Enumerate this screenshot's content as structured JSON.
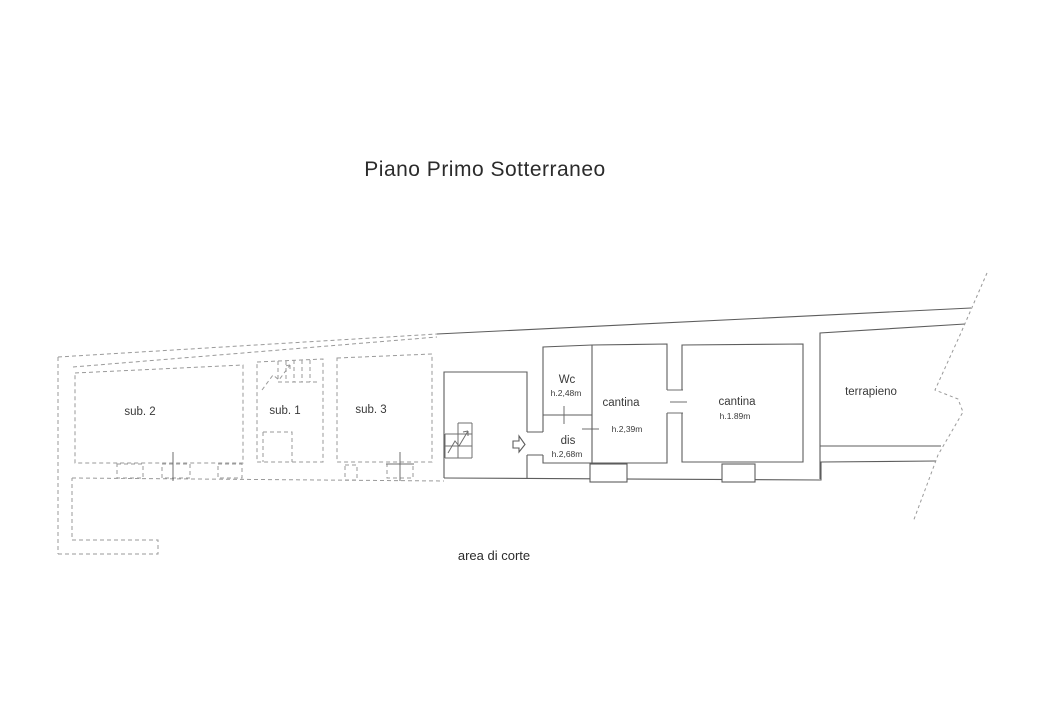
{
  "page": {
    "background": "#ffffff",
    "title": "Piano Primo Sotterraneo",
    "footer_label": "area di corte"
  },
  "plan": {
    "left_wing": {
      "rooms": [
        {
          "label": "sub. 2"
        },
        {
          "label": "sub. 1"
        },
        {
          "label": "sub. 3"
        }
      ]
    },
    "main_wing": {
      "rooms": [
        {
          "label": "Wc",
          "height": "h.2,48m"
        },
        {
          "label": "dis",
          "height": "h.2,68m"
        },
        {
          "label": "cantina",
          "height": "h.2,39m"
        },
        {
          "label": "cantina",
          "height": "h.1.89m"
        },
        {
          "label": "terrapieno"
        }
      ]
    },
    "icons": {
      "stairs_main": "stairs-icon",
      "stairs_sub1": "stairs-icon",
      "entrance_arrow": "entrance-arrow-icon"
    },
    "colors": {
      "solid_line": "#6f6f6f",
      "dashed_line": "#9a9a9a",
      "terrain_line": "#9a9a9a",
      "text": "#3a3a3a",
      "title_text": "#2b2b2b"
    }
  }
}
